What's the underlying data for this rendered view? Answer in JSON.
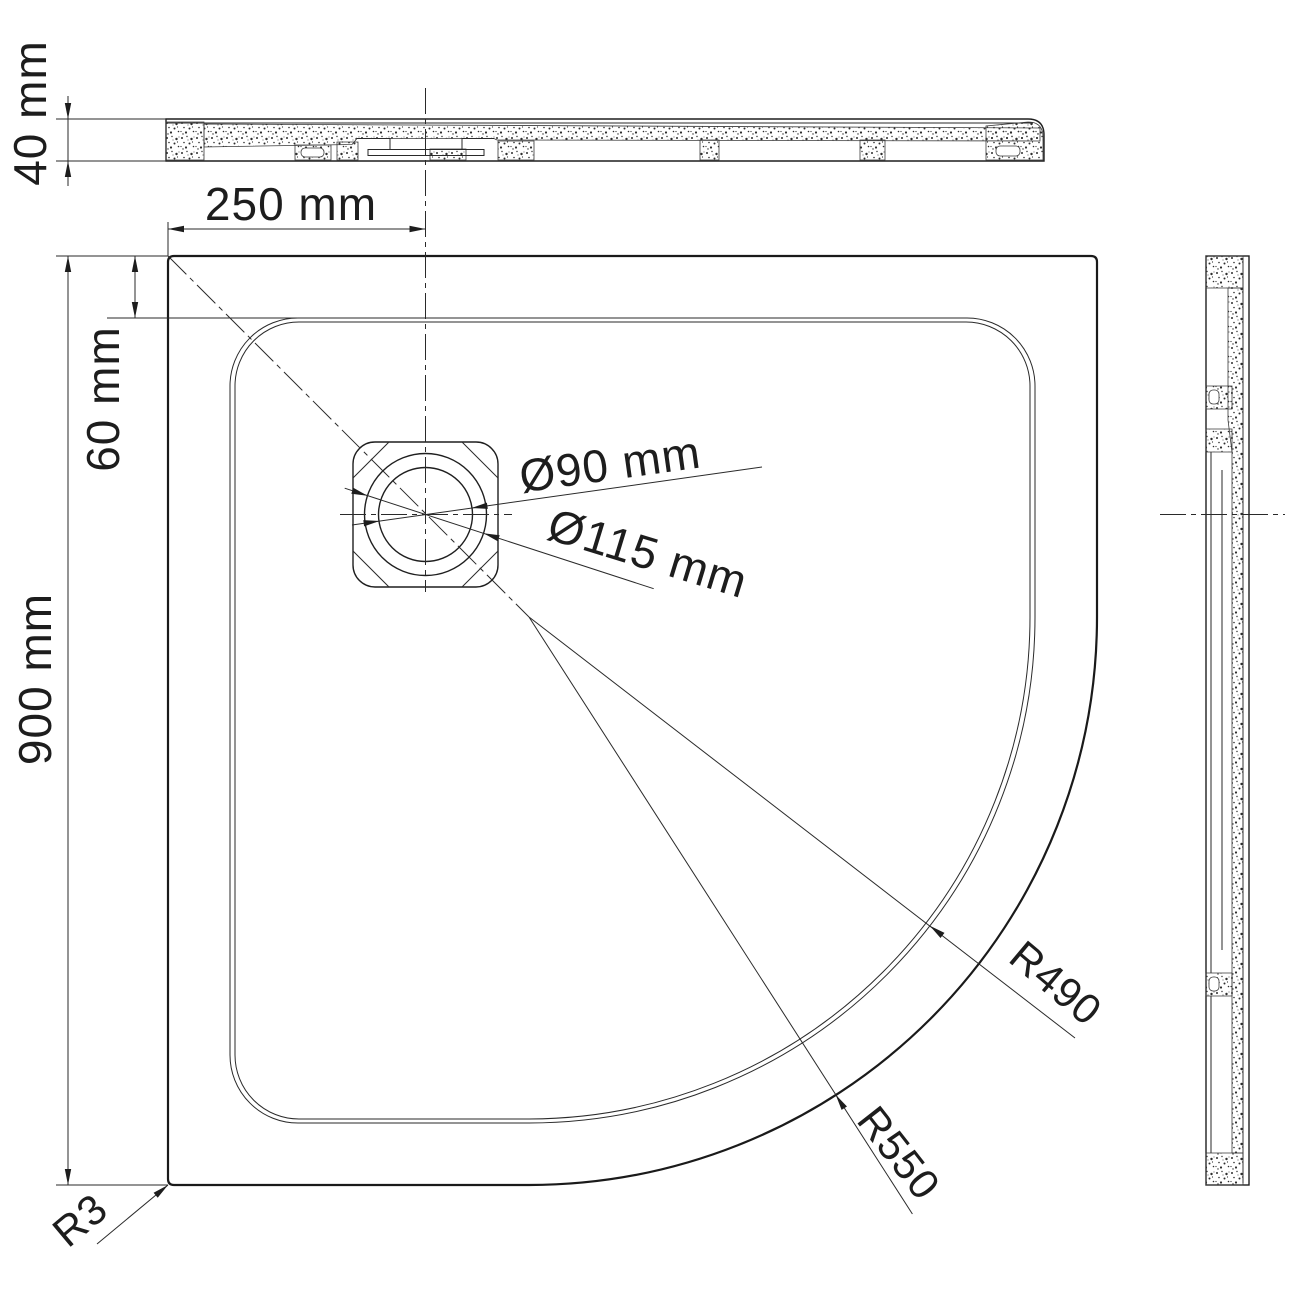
{
  "drawing": {
    "description": "Quadrant shower tray technical drawing with top cross-section, plan view and side cross-section",
    "labels": {
      "tray_thickness": "40 mm",
      "drain_offset_horizontal": "250 mm",
      "rim_to_basin": "60 mm",
      "overall_width": "900 mm",
      "drain_inner_diameter": "Ø90 mm",
      "drain_flange_diameter": "Ø115 mm",
      "basin_corner_radius": "R490",
      "outer_corner_radius": "R550",
      "edge_corner_radius": "R3"
    }
  }
}
